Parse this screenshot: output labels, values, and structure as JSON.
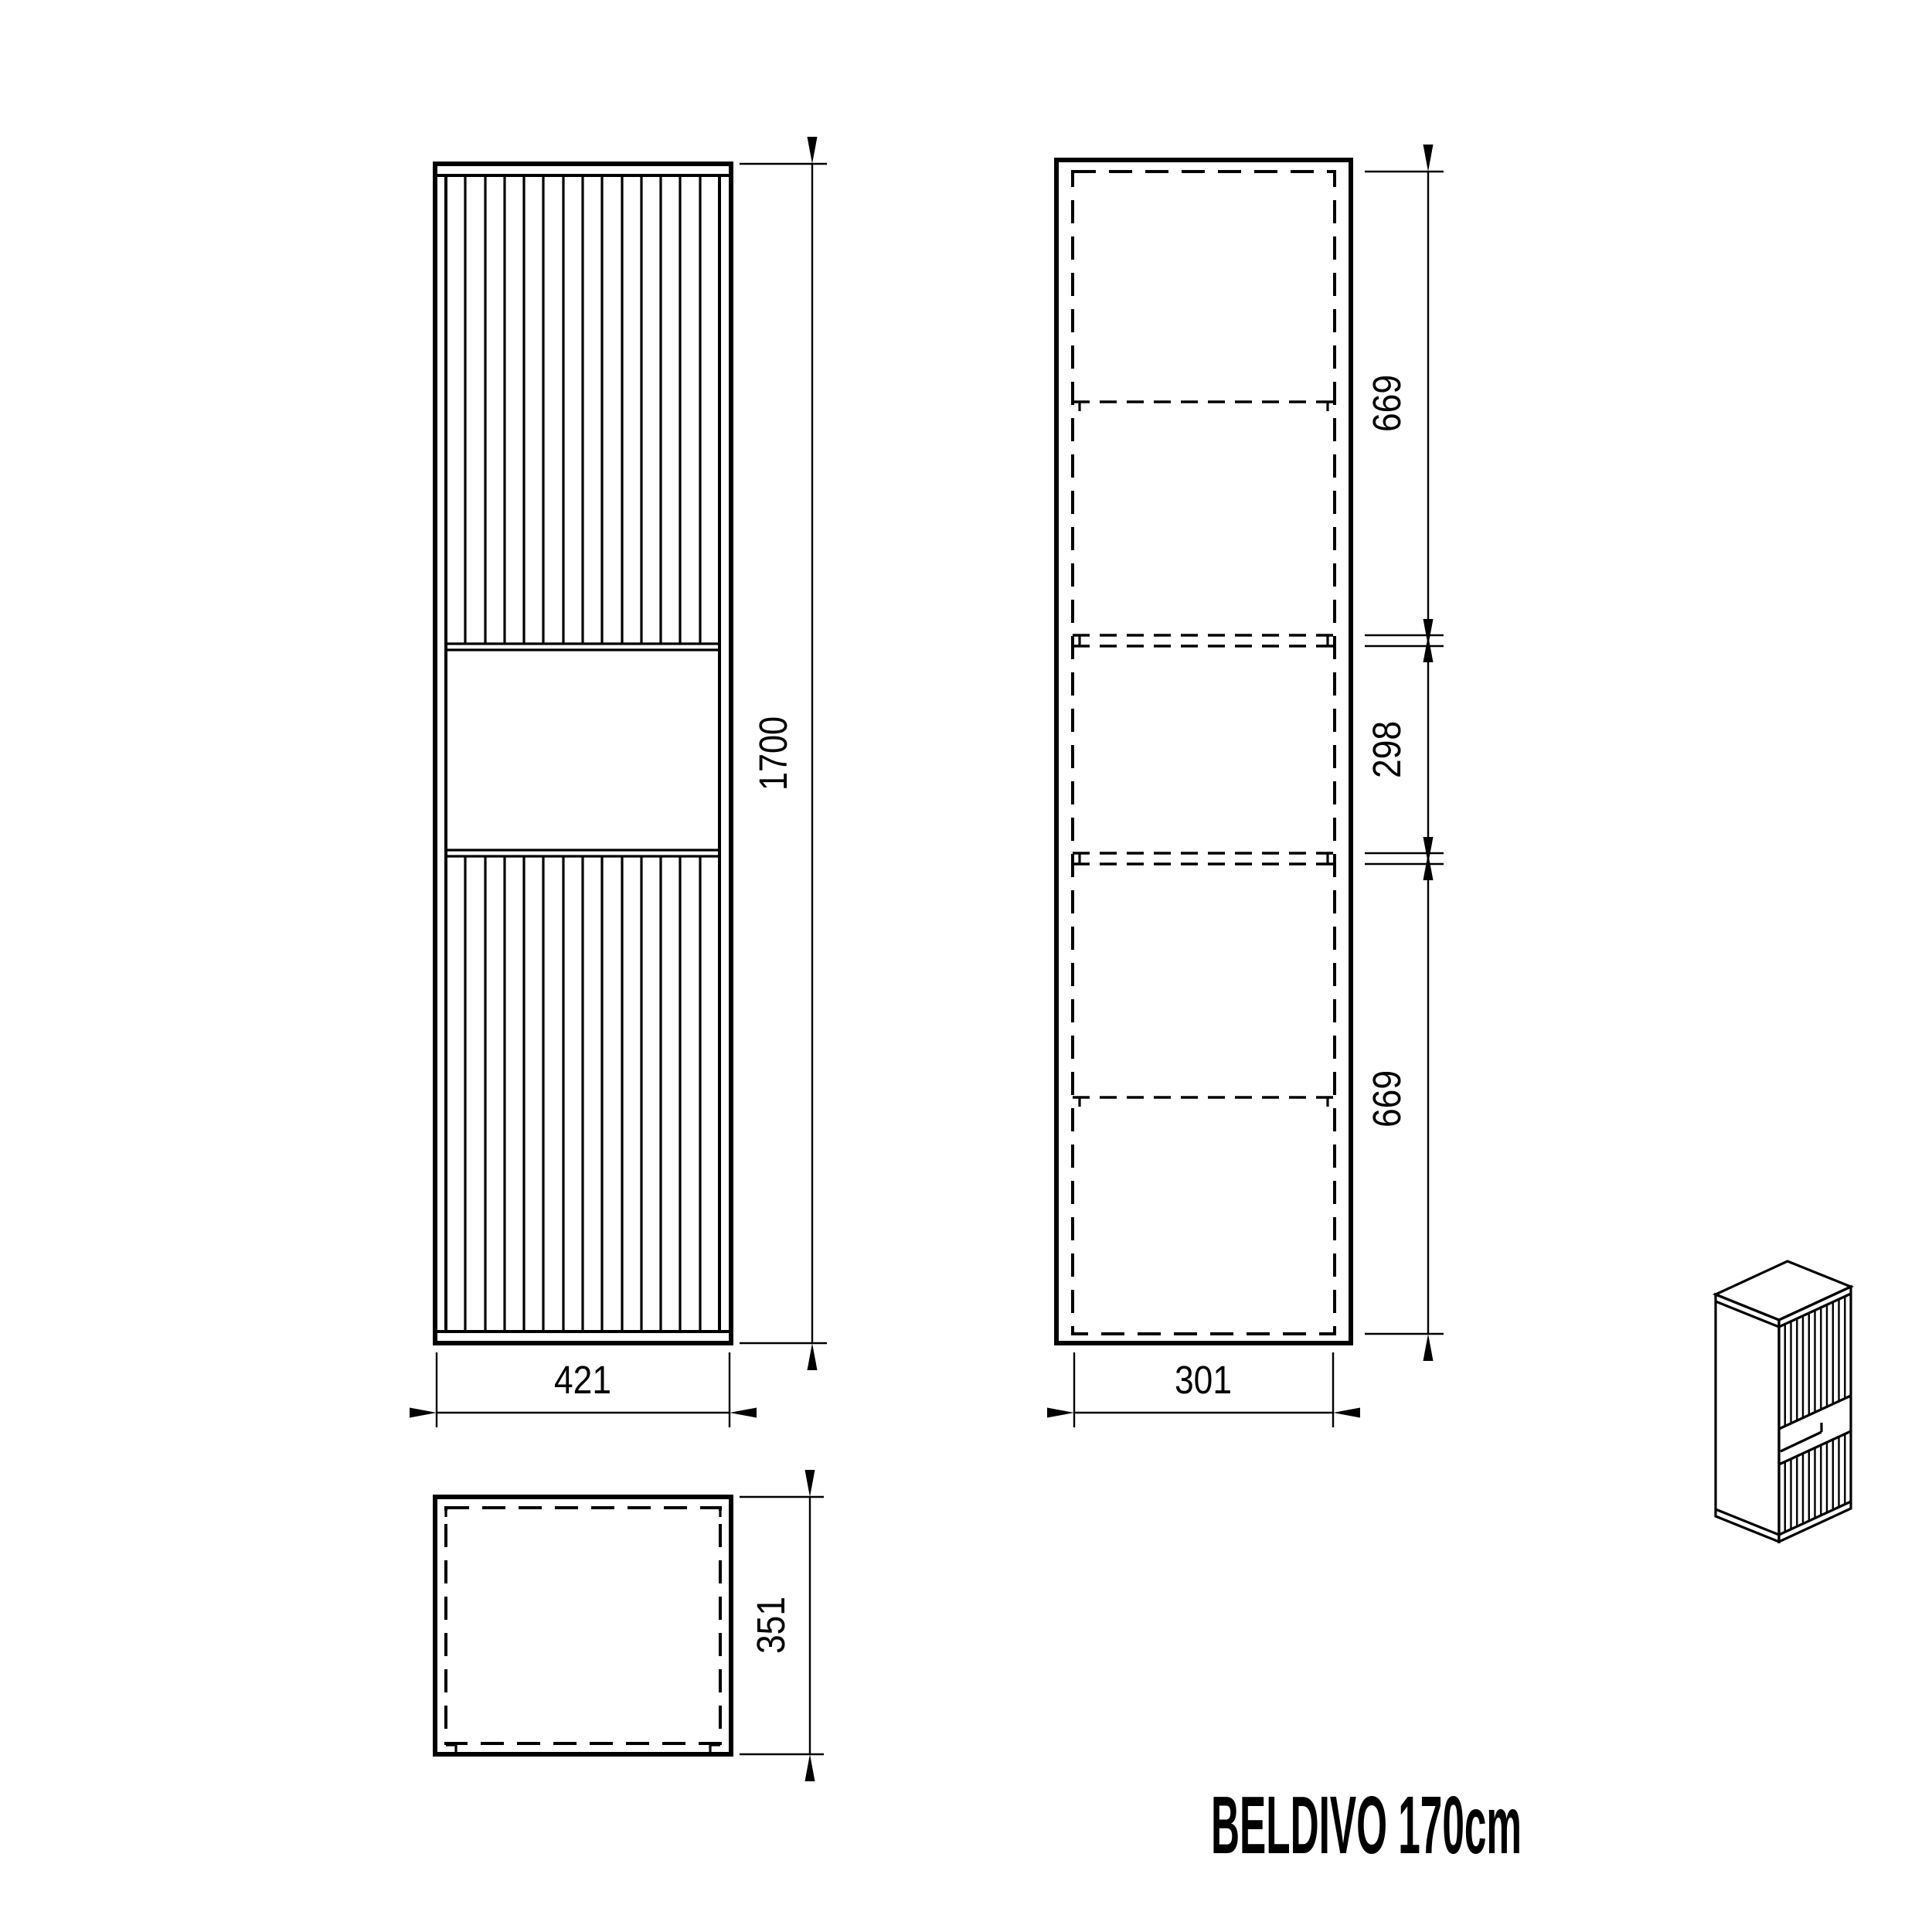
{
  "title": "BELDIVO 170cm",
  "colors": {
    "line": "#000000",
    "background": "#ffffff"
  },
  "views": {
    "front": {
      "label": "front-elevation",
      "width": "421",
      "height": "1700"
    },
    "section": {
      "label": "side-section",
      "width": "301",
      "seg_top": "669",
      "seg_mid": "298",
      "seg_bottom": "669"
    },
    "top": {
      "label": "top-plan",
      "depth": "351"
    },
    "iso": {
      "label": "isometric-preview"
    }
  }
}
